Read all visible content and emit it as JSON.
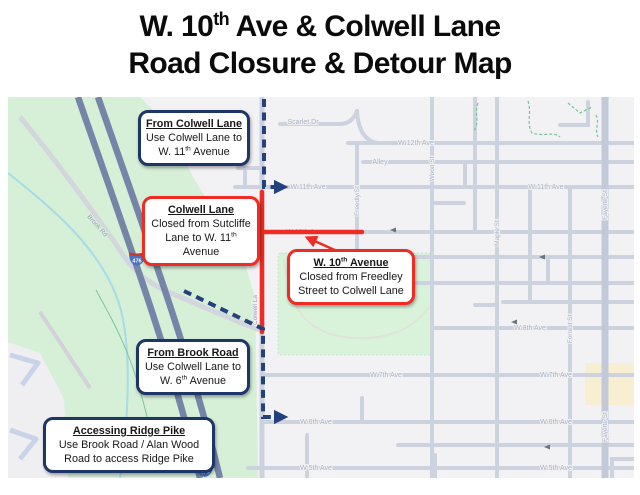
{
  "title": {
    "line1_pre": "W. 10",
    "line1_sup": "th",
    "line1_post": " Ave & Colwell Lane",
    "line2": "Road Closure & Detour Map"
  },
  "colors": {
    "closure_red": "#ee2c24",
    "detour_navy": "#24417e",
    "callout_navy_border": "#1c3667",
    "park_green": "#d6efd7",
    "road_gray": "#cdd3de",
    "highway_blue": "#7585a8",
    "street_label_gray": "#a9b2c4",
    "park_label_teal": "#5fc08b"
  },
  "callouts": {
    "from_colwell": {
      "title": "From Colwell Lane",
      "line1": "Use Colwell Lane to",
      "line2_pre": "W. 11",
      "line2_sup": "th",
      "line2_post": " Avenue"
    },
    "colwell_closure": {
      "title": "Colwell Lane",
      "line1": "Closed from Sutcliffe",
      "line2_pre": "Lane to W. 11",
      "line2_sup": "th",
      "line2_post": " Avenue"
    },
    "w10th_closure": {
      "title_pre": "W. 10",
      "title_sup": "th",
      "title_post": " Avenue",
      "line1": "Closed from Freedley",
      "line2": "Street to Colwell Lane"
    },
    "from_brook": {
      "title": "From Brook Road",
      "line1": "Use Colwell Lane to",
      "line2_pre": "W. 6",
      "line2_sup": "th",
      "line2_post": " Avenue"
    },
    "ridge_pike": {
      "title": "Accessing Ridge Pike",
      "line1": "Use Brook Road / Alan Wood",
      "line2": "Road to access Ridge Pike"
    }
  },
  "map": {
    "street_labels": [
      "Scarlet Dr",
      "W 12th Ave",
      "Alley",
      "W 11th Ave",
      "W 11th Ave",
      "W 10th Ave",
      "W 8th Ave",
      "W 7th Ave",
      "W 7th Ave",
      "W 6th Ave",
      "W 6th Ave",
      "W 5th Ave",
      "W 5th Ave",
      "Wood St",
      "Maple St",
      "Forrest St",
      "Fayette St",
      "Fayette St",
      "Freedly St",
      "Colwell La",
      "Brook Rd"
    ],
    "park_label": "Sutcliffe Park",
    "highway_shield": "476"
  }
}
